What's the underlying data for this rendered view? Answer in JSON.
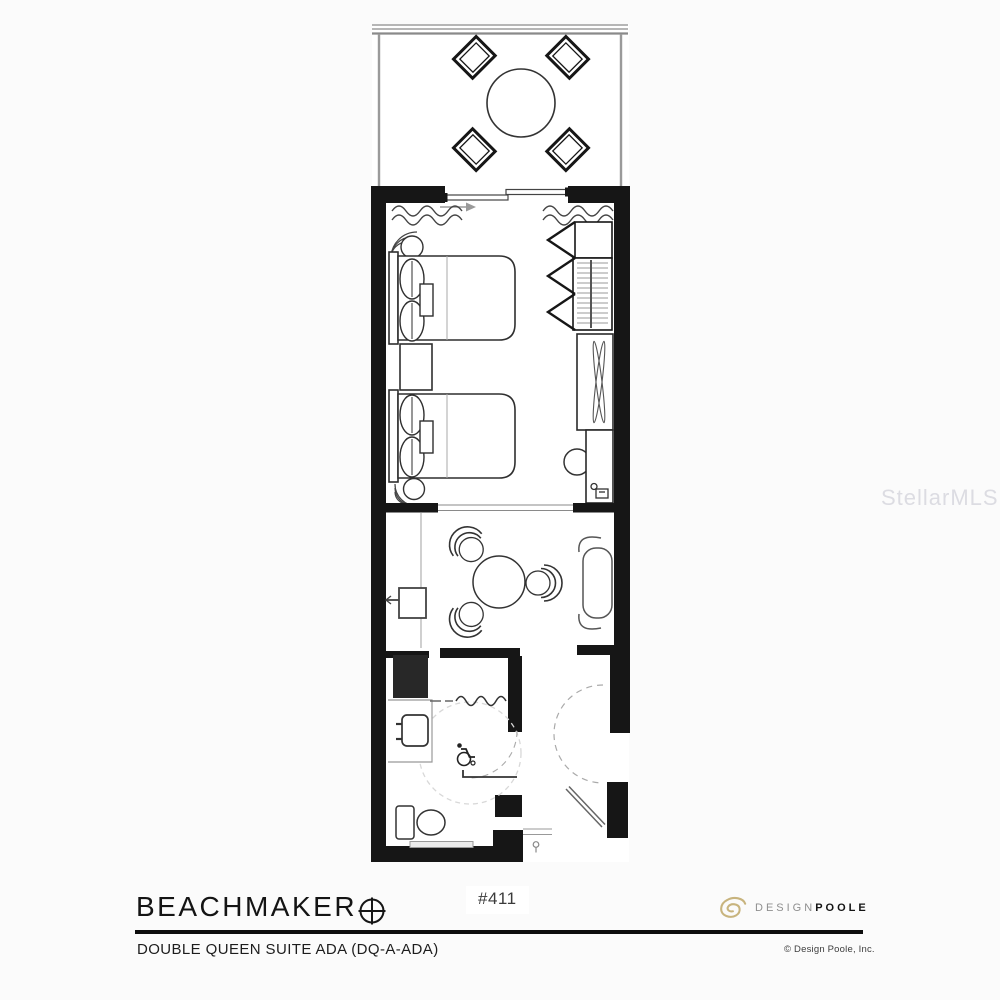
{
  "watermark": {
    "text": "StellarMLS"
  },
  "title_block": {
    "title": "BEACHMAKER",
    "room_number": "#411",
    "subtitle": "DOUBLE QUEEN SUITE ADA (DQ-A-ADA)",
    "logo": {
      "word1": "DESIGN",
      "word2": "POOLE"
    },
    "copyright": "© Design Poole, Inc."
  },
  "colors": {
    "wall": "#161616",
    "furniture_line": "#2f2f2f",
    "light_line": "#999999",
    "dashed_line": "#d8d8d8",
    "logo_gold": "#c8b47e",
    "watermark": "#c3c3cd",
    "background": "#fbfbfb"
  },
  "floor_plan": {
    "unit_name": "Double Queen Suite ADA",
    "unit_code": "DQ-A-ADA",
    "room_number": "#411",
    "areas": [
      {
        "name": "balcony",
        "furniture": [
          "round-patio-table",
          "patio-chair",
          "patio-chair",
          "patio-chair",
          "patio-chair",
          "railing",
          "sliding-glass-door"
        ]
      },
      {
        "name": "bedroom",
        "furniture": [
          "queen-bed",
          "queen-bed",
          "nightstand",
          "corner-lamp",
          "corner-lamp",
          "curtains",
          "closet-bifold-doors",
          "closet-shelf",
          "hanging-rod-with-hangers",
          "tv-console",
          "television",
          "desk",
          "desk-chair",
          "telephone"
        ]
      },
      {
        "name": "sitting-area",
        "furniture": [
          "round-table",
          "lounge-chair",
          "lounge-chair",
          "lounge-chair",
          "chaise-lounge",
          "wall-mounted-tv"
        ]
      },
      {
        "name": "ada-bathroom",
        "furniture": [
          "vanity-sink",
          "toilet",
          "roll-in-shower",
          "shower-curtain",
          "grab-bar",
          "wheelchair-symbol",
          "wheelchair-turning-circle",
          "bathroom-door"
        ]
      },
      {
        "name": "entry",
        "furniture": [
          "entry-door",
          "door-swing-arc",
          "threshold"
        ]
      }
    ]
  }
}
